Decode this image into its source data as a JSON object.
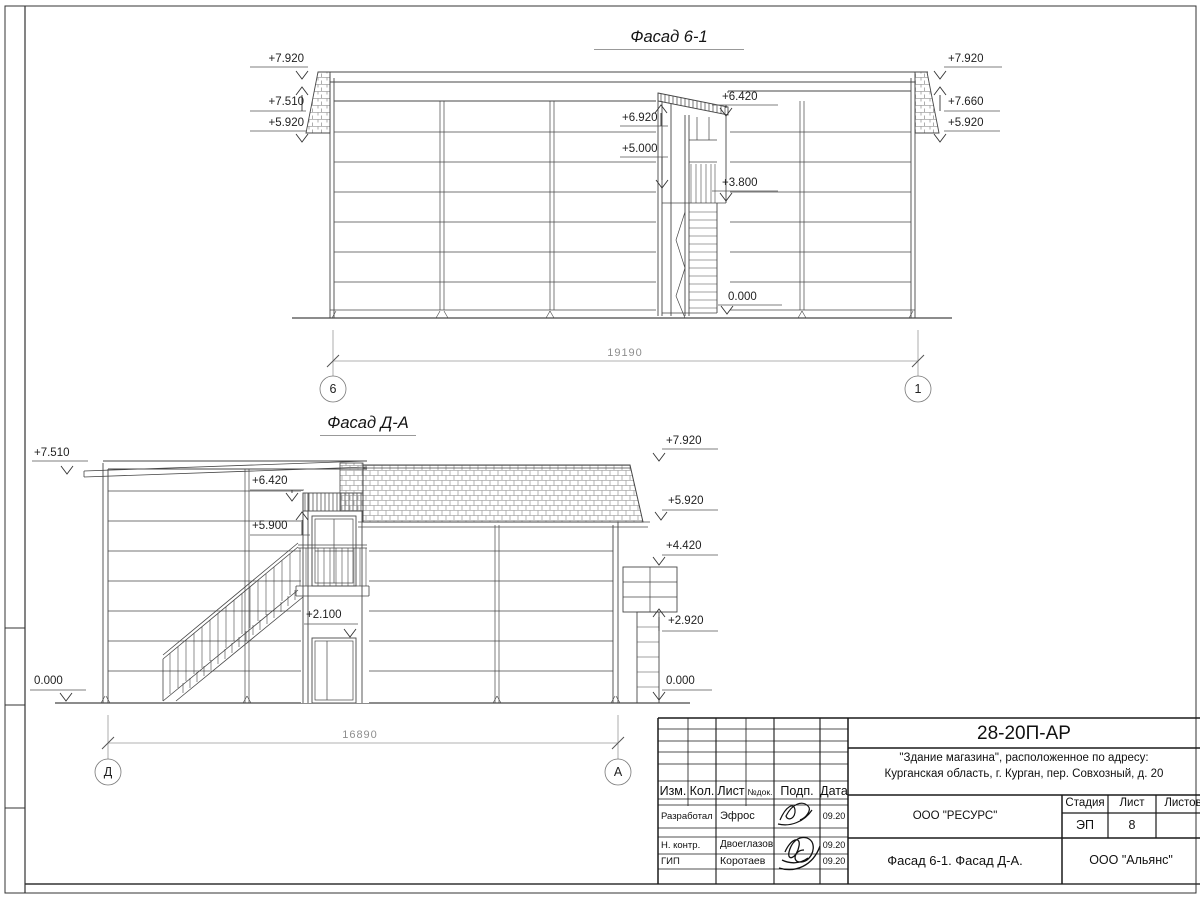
{
  "drawing": {
    "facade1": {
      "title": "Фасад 6-1",
      "marks": {
        "left1": "+7.920",
        "left2": "+7.510",
        "left3": "+5.920",
        "right1": "+7.920",
        "right2": "+7.660",
        "right3": "+5.920",
        "mid_roof": "+6.420",
        "mid_top": "+6.920",
        "mid_upper": "+5.000",
        "mid_landing": "+3.800",
        "mid_ground": "0.000"
      },
      "dimension": "19190",
      "axis_left": "6",
      "axis_right": "1"
    },
    "facade2": {
      "title": "Фасад Д-А",
      "marks": {
        "left_top": "+7.510",
        "canopy": "+6.420",
        "door_top": "+5.900",
        "lower_door": "+2.100",
        "left_ground": "0.000",
        "right_top": "+7.920",
        "right_eaves": "+5.920",
        "sign_top": "+4.420",
        "sign_bottom": "+2.920",
        "right_ground": "0.000"
      },
      "dimension": "16890",
      "axis_left": "Д",
      "axis_right": "А"
    }
  },
  "title_block": {
    "code": "28-20П-АР",
    "project_line1": "\"Здание магазина\", расположенное по адресу:",
    "project_line2": "Курганская область, г. Курган, пер. Совхозный, д. 20",
    "cols": {
      "izm": "Изм.",
      "kol": "Кол.",
      "list": "Лист",
      "ndok": "№док.",
      "podp": "Подп.",
      "data": "Дата"
    },
    "rows": {
      "developed_role": "Разработал",
      "developed_name": "Эфрос",
      "developed_date": "09.20",
      "ncontrol_role": "Н. контр.",
      "ncontrol_name": "Двоеглазов",
      "ncontrol_date": "09.20",
      "gip_role": "ГИП",
      "gip_name": "Коротаев",
      "gip_date": "09.20"
    },
    "org_top": "ООО \"РЕСУРС\"",
    "stage_label": "Стадия",
    "sheet_label": "Лист",
    "sheets_label": "Листов",
    "stage_value": "ЭП",
    "sheet_value": "8",
    "drawing_title": "Фасад 6-1. Фасад Д-А.",
    "org_bottom": "ООО \"Альянс\""
  }
}
